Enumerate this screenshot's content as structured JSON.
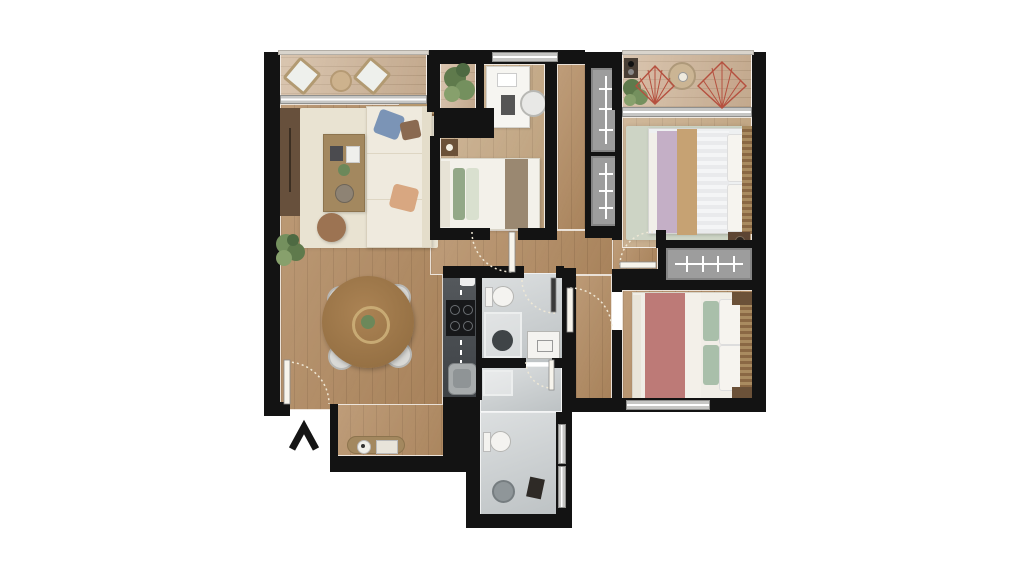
{
  "title": "apartment-floor-plan",
  "compass": {
    "direction": "north",
    "symbol": "up-chevron"
  },
  "colors": {
    "wall": "#131313",
    "wood": "#b28a60",
    "woodLight": "#c3a57f",
    "woodDark": "#9c7850",
    "deck": "#cdb295",
    "tileA": "#dcdfe0",
    "tileB": "#bdc2c4",
    "rugCream": "#e9e3d2",
    "rugSage": "#cdd4c5",
    "closet": "#9d9d9d",
    "counter": "#45494d",
    "cooktop": "#17181a",
    "accentRed": "#b5503f",
    "bedPink": "#bd7a77",
    "bedLavender": "#c4afc6",
    "bedTan": "#c6a273",
    "pillowBlue": "#7b94b6",
    "pillowPeach": "#d8a781",
    "pillowSage": "#93a888",
    "throwBrown": "#9a8871",
    "woodFurn": "#a3885f",
    "woodFurnDark": "#6b5138",
    "plantGreen": "#5f7a4c",
    "fixtureWhite": "#f4f3f0"
  },
  "rooms": [
    {
      "id": "balcony-left",
      "name": "balcony",
      "furniture": [
        "lounge chair",
        "lounge chair",
        "round side table",
        "sliding window"
      ]
    },
    {
      "id": "living-room",
      "name": "living room",
      "furniture": [
        "sofa with pillows",
        "coffee table",
        "pouf",
        "tv cabinet",
        "cream rug",
        "floor plant",
        "slat bench"
      ]
    },
    {
      "id": "dining-area",
      "name": "dining area",
      "furniture": [
        "round dining table",
        "chair",
        "chair",
        "chair",
        "chair",
        "centerpiece plant",
        "console sideboard"
      ]
    },
    {
      "id": "entry",
      "name": "entry",
      "furniture": [
        "entry door"
      ]
    },
    {
      "id": "kitchen",
      "name": "kitchen",
      "furniture": [
        "counter",
        "cooktop",
        "sink"
      ]
    },
    {
      "id": "bedroom-single",
      "name": "single bedroom",
      "furniture": [
        "single bed",
        "desk",
        "desk chair",
        "laptop",
        "nightstand with lamp",
        "corner plant"
      ]
    },
    {
      "id": "hallway",
      "name": "hallway",
      "furniture": [
        "closet",
        "closet"
      ]
    },
    {
      "id": "balcony-right",
      "name": "balcony",
      "furniture": [
        "acapulco chair",
        "acapulco chair",
        "round table",
        "plant",
        "side console"
      ]
    },
    {
      "id": "bedroom-double-top",
      "name": "double bedroom",
      "furniture": [
        "double bed",
        "sage rug",
        "nightstand",
        "wardrobe"
      ]
    },
    {
      "id": "bedroom-double-bottom",
      "name": "double bedroom",
      "furniture": [
        "double bed",
        "nightstand",
        "nightstand",
        "window"
      ]
    },
    {
      "id": "bathroom-main",
      "name": "bathroom",
      "furniture": [
        "toilet",
        "shower",
        "washer vanity"
      ]
    },
    {
      "id": "bathroom-second",
      "name": "second bathroom",
      "furniture": [
        "shower stall",
        "toilet",
        "shower drain",
        "stool",
        "window"
      ]
    }
  ]
}
